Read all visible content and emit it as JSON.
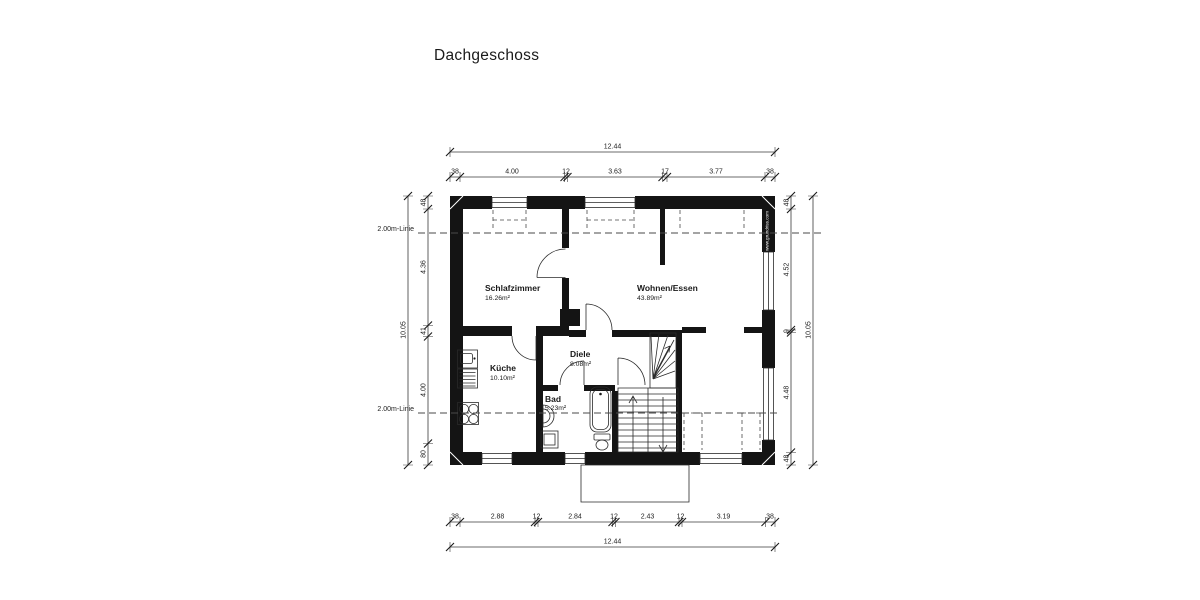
{
  "title": "Dachgeschoss",
  "watermark": "www.grundriss.com",
  "annotations": {
    "line2m_label": "2.00m-Linie"
  },
  "rooms": {
    "schlafzimmer": {
      "name": "Schlafzimmer",
      "area": "16.26m²"
    },
    "wohnen": {
      "name": "Wohnen/Essen",
      "area": "43.89m²"
    },
    "kueche": {
      "name": "Küche",
      "area": "10.10m²"
    },
    "diele": {
      "name": "Diele",
      "area": "8.08m²"
    },
    "bad": {
      "name": "Bad",
      "area": "5.23m²"
    }
  },
  "dims": {
    "top": {
      "overall": "12.44",
      "segments": [
        "38",
        "4.00",
        "12",
        "3.63",
        "17",
        "3.77",
        "38"
      ]
    },
    "bottom": {
      "overall": "12.44",
      "segments": [
        "38",
        "2.88",
        "12",
        "2.84",
        "12",
        "2.43",
        "12",
        "3.19",
        "38"
      ]
    },
    "left": {
      "overall": "10.05",
      "segments": [
        "48",
        "4.36",
        "41",
        "4.00",
        "80"
      ]
    },
    "right": {
      "overall": "10.05",
      "segments": [
        "48",
        "4.52",
        "9",
        "4.48",
        "48"
      ]
    }
  }
}
